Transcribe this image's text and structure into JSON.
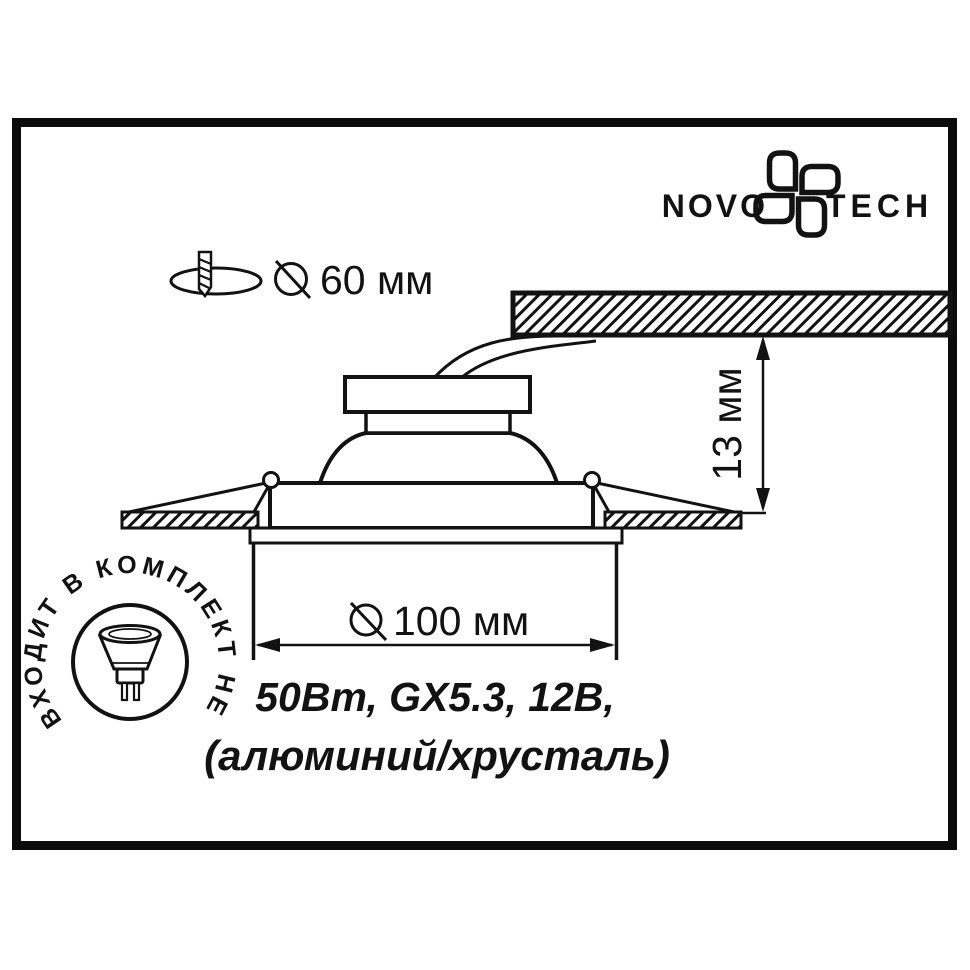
{
  "logo": {
    "left": "NOVO",
    "right": "TECH"
  },
  "labels": {
    "cutout_dia": "60 мм",
    "visible_dia": "100 мм",
    "recess_depth": "13 мм",
    "spec_line1": "50Вт, GX5.3, 12В,",
    "spec_line2": "(алюминий/хрусталь)",
    "stamp_text": "ВХОДИТ В КОМПЛЕКТ НЕ"
  },
  "colors": {
    "ink": "#121212",
    "background": "#ffffff"
  }
}
